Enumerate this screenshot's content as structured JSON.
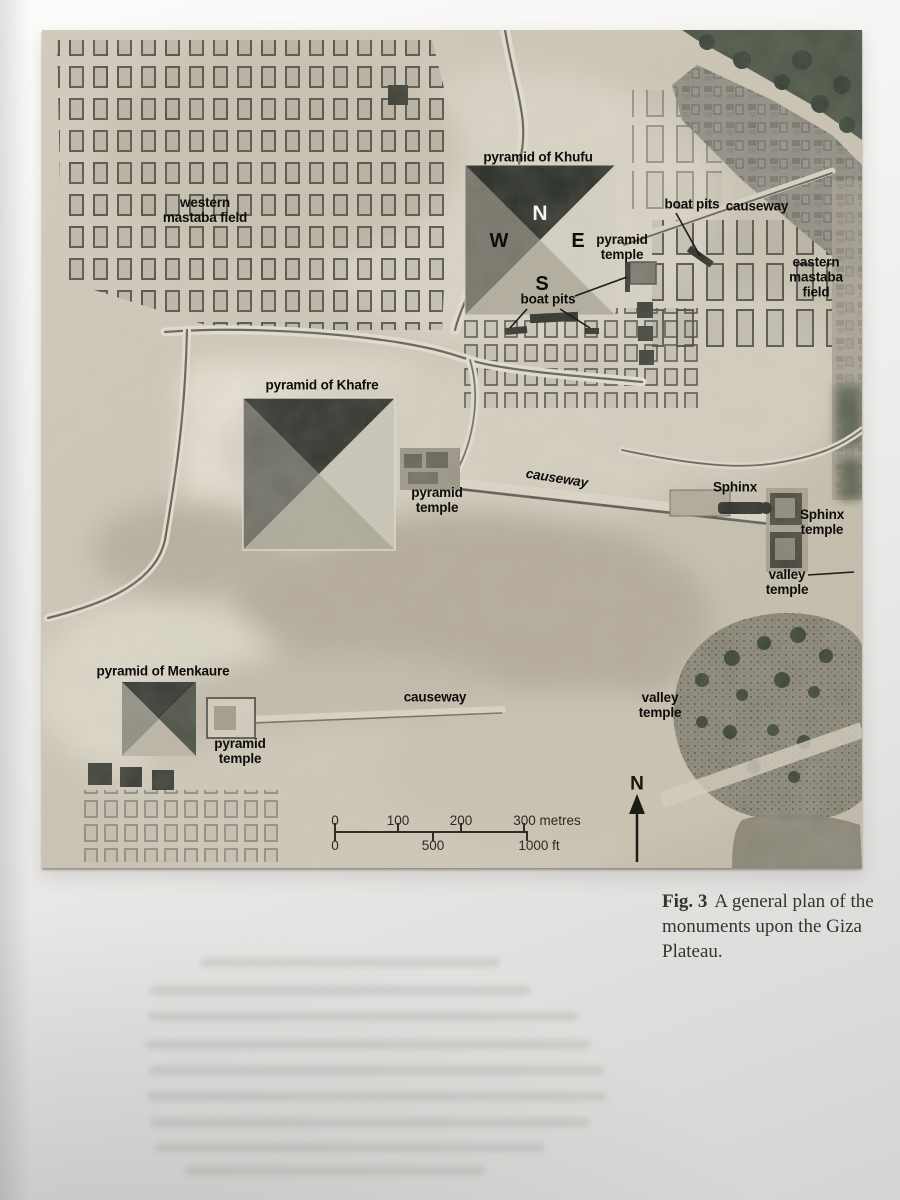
{
  "map": {
    "labels": {
      "khufu": "pyramid of Khufu",
      "western_field": [
        "western",
        "mastaba field"
      ],
      "boat_pits_top": "boat pits",
      "causeway_top": "causeway",
      "khufu_temple": [
        "pyramid",
        "temple"
      ],
      "eastern_field": [
        "eastern",
        "mastaba",
        "field"
      ],
      "boat_pits_south": "boat pits",
      "khafre": "pyramid of Khafre",
      "khafre_temple": [
        "pyramid",
        "temple"
      ],
      "causeway_mid": "causeway",
      "sphinx": "Sphinx",
      "sphinx_temple": [
        "Sphinx",
        "temple"
      ],
      "valley_temple_right": [
        "valley",
        "temple"
      ],
      "menkaure": "pyramid of Menkaure",
      "menkaure_temple": [
        "pyramid",
        "temple"
      ],
      "causeway_bottom": "causeway",
      "valley_temple_bottom": [
        "valley",
        "temple"
      ]
    },
    "compass": {
      "n": "N",
      "w": "W",
      "e": "E",
      "s": "S"
    },
    "scale_bar": {
      "metres_ticks": [
        "0",
        "100",
        "200",
        "300 metres"
      ],
      "feet_ticks": [
        "0",
        "500",
        "1000 ft"
      ]
    },
    "north_label": "N",
    "colors": {
      "sand": "#cfc8b8",
      "pyramid_shadow": "#1e231d",
      "vegetation": "#414b3c",
      "label_text": "#0d0d0b"
    }
  },
  "caption": {
    "figure_label": "Fig. 3",
    "text": "A general plan of the monuments upon the Giza Plateau."
  }
}
